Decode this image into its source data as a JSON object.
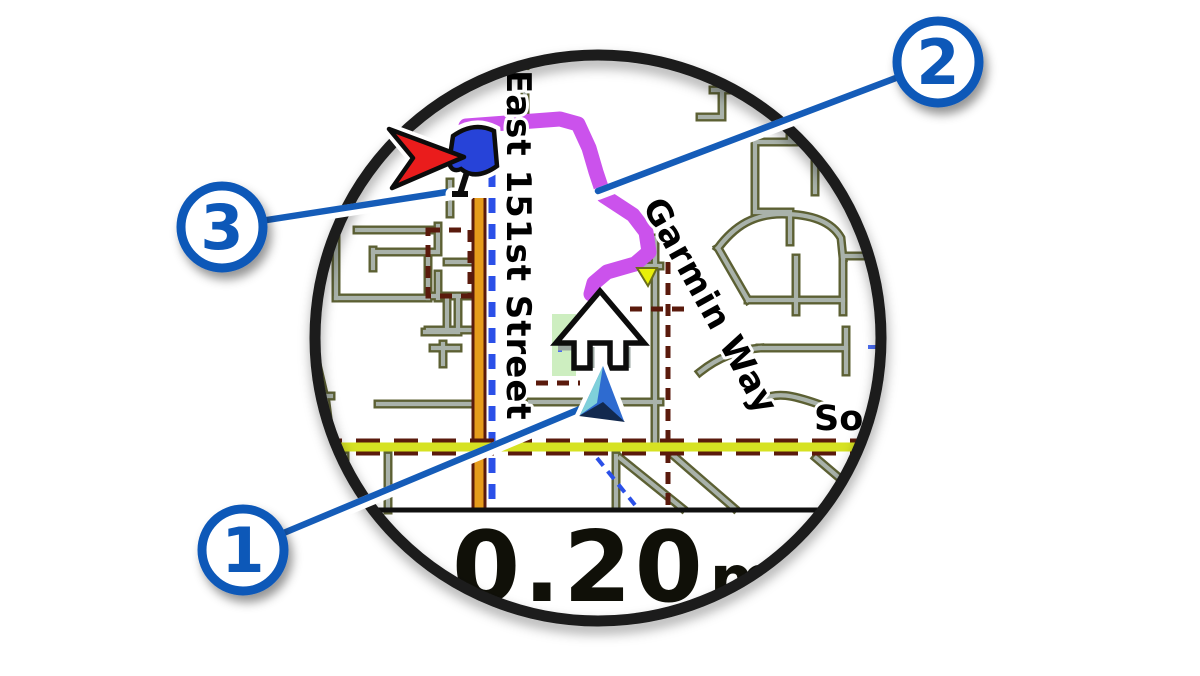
{
  "watch": {
    "distance_field": {
      "value": "0.20",
      "unit": "mi"
    },
    "map": {
      "street_label_vertical": "East 151st Street",
      "street_label_diagonal": "Garmin Way",
      "street_label_clipped": "Sout",
      "icons": {
        "position_marker": "blue-triangle-current-location",
        "navigation_arrow": "white-up-arrow",
        "destination_marker": "red-arrow-with-blue-flag",
        "route_line": "magenta-course-route"
      }
    }
  },
  "callouts": [
    {
      "number": "1",
      "target": "position-marker"
    },
    {
      "number": "2",
      "target": "route-line"
    },
    {
      "number": "3",
      "target": "destination-marker"
    }
  ],
  "colors": {
    "callout_blue": "#0f58b8",
    "route_magenta": "#cb52ec",
    "road_orange": "#e69c1c",
    "road_yellow": "#d6e222",
    "trail_maroon": "#5a1a0c",
    "road_gray": "#a9b2aa",
    "road_casing_olive": "#5c6033",
    "bezel_black": "#1a1a1a",
    "marker_red": "#ea1c1c",
    "marker_flag_blue": "#2743d8",
    "position_cyan": "#7fd0da",
    "position_blue": "#2e6bd0",
    "position_navy": "#12294e",
    "park_green": "#cdeec0"
  }
}
